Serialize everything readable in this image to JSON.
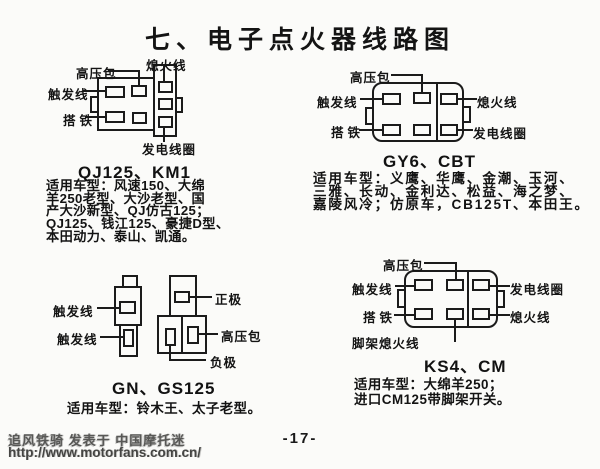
{
  "page": {
    "title": "七、电子点火器线路图",
    "page_number": "-17-",
    "watermark": {
      "byline": "追风铁骑 发表于 中国摩托迷",
      "url": "http://www.motorfans.com.cn/"
    }
  },
  "labels": {
    "high_voltage_coil": "高压包",
    "kill_wire": "熄火线",
    "trigger_wire": "触发线",
    "ground": "搭铁",
    "generator_coil": "发电线圈",
    "positive": "正极",
    "negative": "负极",
    "stand_kill_wire": "脚架熄火线"
  },
  "diagrams": {
    "qj125_km1": {
      "title": "QJ125、KM1",
      "applicable_lines": [
        "适用车型：风速150、大绵",
        "羊250老型、大沙老型、国",
        "产大沙新型、QJ仿古125；",
        "QJ125、钱江125、豪捷D型、",
        "本田动力、泰山、凯通。"
      ]
    },
    "gy6_cbt": {
      "title": "GY6、CBT",
      "applicable_lines": [
        "适用车型：义鹰、华鹰、金潮、玉河、",
        "三雅、长动、金利达、松益、海之梦、",
        "嘉陵风冷；仿原车，CB125T、本田王。"
      ]
    },
    "gn_gs125": {
      "title": "GN、GS125",
      "applicable_lines": [
        "适用车型：铃木王、太子老型。"
      ]
    },
    "ks4_cm": {
      "title": "KS4、CM",
      "applicable_lines": [
        "适用车型：大绵羊250；",
        "进口CM125带脚架开关。"
      ]
    }
  }
}
